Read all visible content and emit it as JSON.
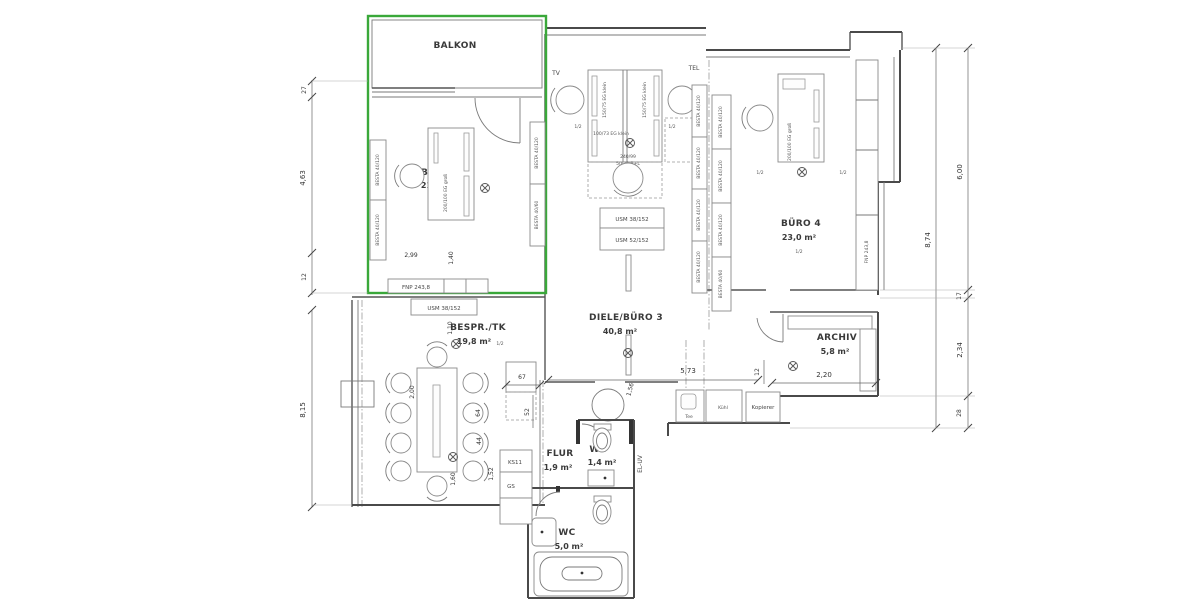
{
  "highlight": {
    "color": "#3aa83a"
  },
  "rooms": {
    "balkon": {
      "name": "BALKON"
    },
    "buero2": {
      "name": "BÜRO 2",
      "area": "21,0 m²"
    },
    "bespr": {
      "name": "BESPR./TK",
      "area": "19,8 m²"
    },
    "diele": {
      "name": "DIELE/BÜRO 3",
      "area": "40,8 m²"
    },
    "buero4": {
      "name": "BÜRO 4",
      "area": "23,0 m²"
    },
    "archiv": {
      "name": "ARCHIV",
      "area": "5,8 m²"
    },
    "flur": {
      "name": "FLUR",
      "area": "1,9 m²"
    },
    "wc_klein": {
      "name": "WC",
      "area": "1,4 m²"
    },
    "wc_gross": {
      "name": "WC",
      "area": "5,0 m²"
    }
  },
  "furniture": {
    "besta": "BESTA 40/120",
    "besta_klein": "BESTA 40/60",
    "usm38": "USM 38/152",
    "usm52": "USM 52/152",
    "fnp": "FNP 243,8",
    "schreibtisch_gross": "200/100 EG groß",
    "schreibtisch_klein": "150/75 EG klein",
    "schreibtisch_100": "100/73 EG klein",
    "tisch_240": "240/99",
    "tisch_240_zusatz": "50/75 B+L",
    "kopierer": "Kopierer",
    "ks11": "KS11",
    "gs": "GS",
    "tee": "Tee",
    "kuehl": "Kühl"
  },
  "annotations": {
    "tv": "TV",
    "tel": "TEL",
    "el_uv": "EL-UV",
    "half": "1/2"
  },
  "dimensions": {
    "left": [
      "27",
      "4,63",
      "12",
      "8,15"
    ],
    "right_segments": [
      "6,00",
      "17",
      "2,34",
      "28"
    ],
    "right_total": "8,74",
    "horizontal": {
      "flur_breite": "5,73",
      "archiv_breite": "2,20",
      "wand": "12"
    },
    "interior": {
      "d299": "2,99",
      "d140": "1,40",
      "d110": "1,10",
      "d200": "2,00",
      "d64": "64",
      "d44": "44",
      "d152": "1,52",
      "d160": "1,60",
      "d67": "67",
      "d52": "52",
      "d156": "1,56"
    }
  }
}
